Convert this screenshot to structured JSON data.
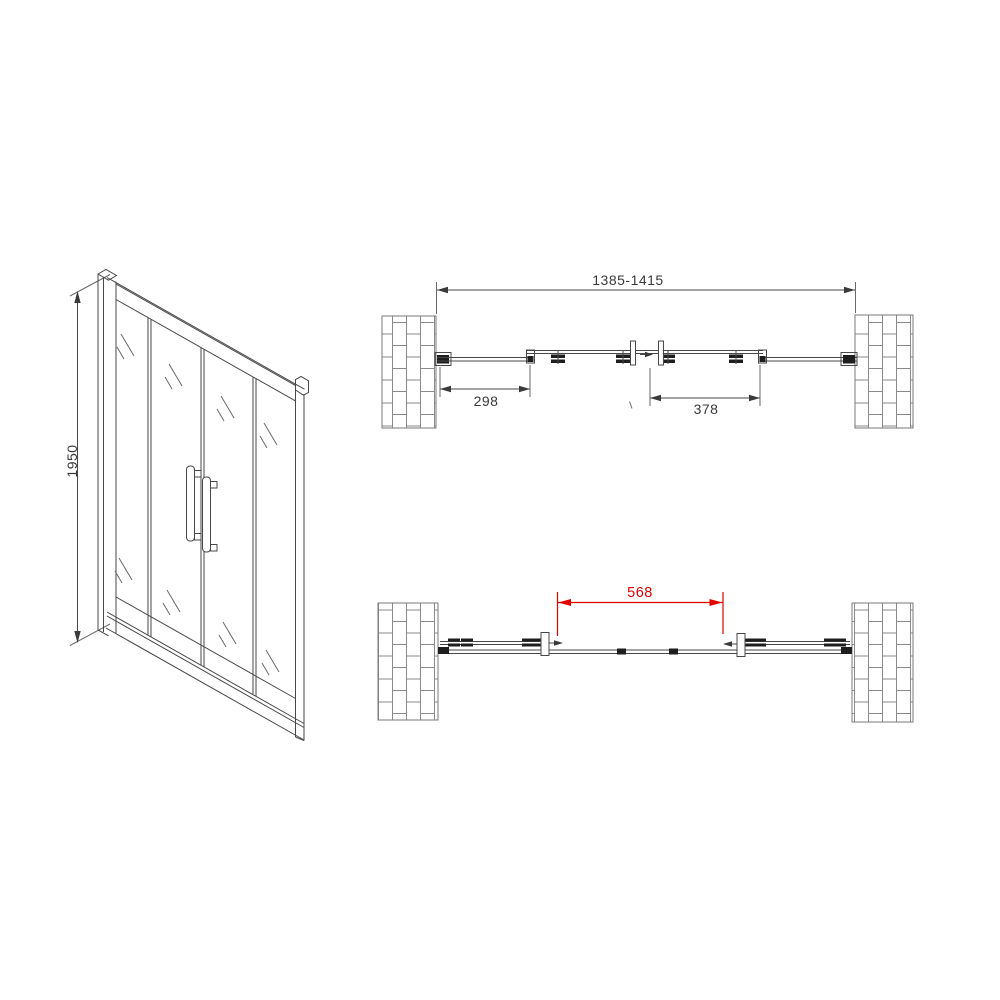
{
  "front_view": {
    "height_dimension": "1950"
  },
  "plan_view_closed": {
    "overall_width": "1385-1415",
    "left_fixed_panel_width": "298",
    "sliding_door_width": "378"
  },
  "plan_view_open": {
    "opening_width": "568"
  },
  "colors": {
    "line": "#474747",
    "dark_fill": "#1e1e1e",
    "dimension_highlight": "#e00000",
    "brick_joint": "#8a8a8a",
    "background": "#ffffff"
  }
}
